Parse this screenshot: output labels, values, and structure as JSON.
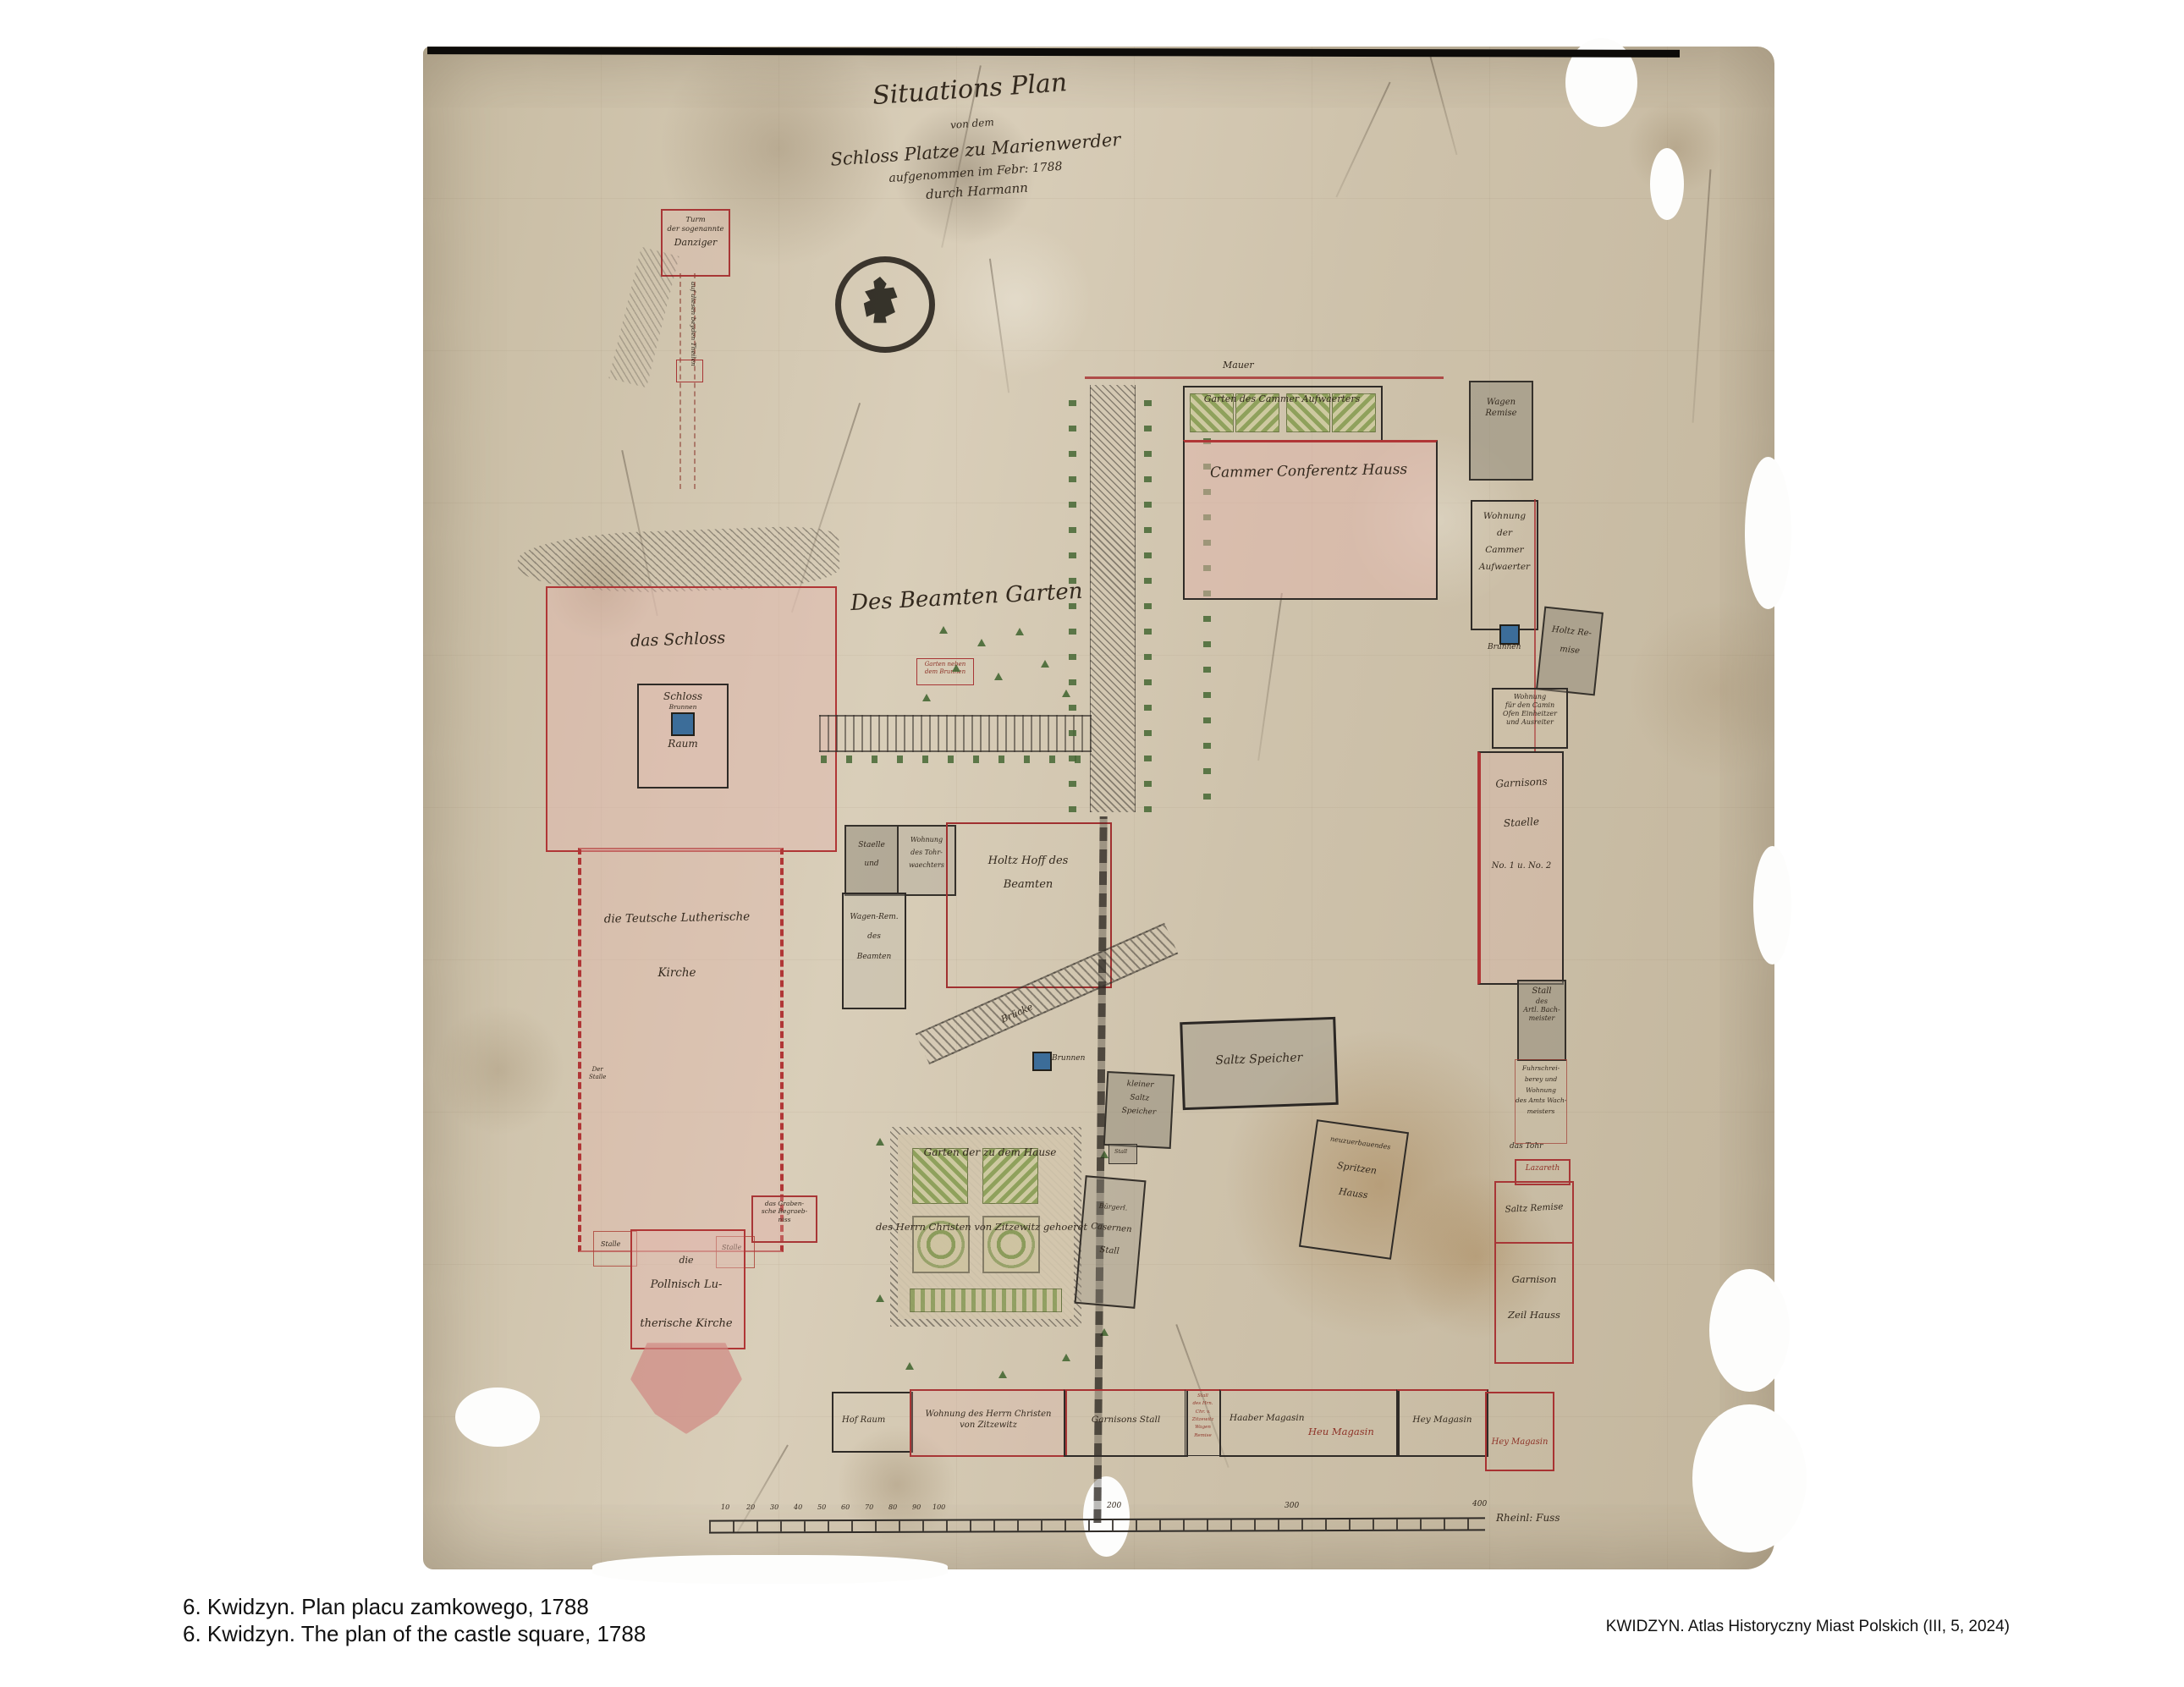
{
  "palette": {
    "red_ink": "#a83636",
    "black_ink": "#2f2b27",
    "pink_wash": "#e2b5ac",
    "garden_green": "#8ca05c",
    "water_blue": "#3c6d99",
    "parchment": "#cfc2aa"
  },
  "captions": {
    "polish": "6. Kwidzyn. Plan placu zamkowego, 1788",
    "english": "6. Kwidzyn. The plan of the castle square, 1788",
    "source": "KWIDZYN. Atlas Historyczny Miast Polskich (III, 5, 2024)"
  },
  "map": {
    "title": {
      "l1": "Situations Plan",
      "l2": "von dem",
      "l3": "Schloss Platze zu Marienwerder",
      "l4": "aufgenommen im Febr: 1788",
      "l5": "durch Harmann"
    },
    "labels": {
      "danziger": {
        "l1": "Turm",
        "l2": "der sogenannte",
        "l3": "Danziger"
      },
      "corridor_note": "auf diesen beyden Theilen",
      "mauer": "Mauer",
      "garten_aufwaerter": "Garten des Cammer Aufwaerters",
      "conferenz_haus": "Cammer Conferentz Hauss",
      "wagen_remise": {
        "l1": "Wagen",
        "l2": "Remise"
      },
      "wohnung_aufwaerter": {
        "l1": "Wohnung",
        "l2": "der",
        "l3": "Cammer",
        "l4": "Aufwaerter"
      },
      "brunnen_right": "Brunnen",
      "holtz_remise": {
        "l1": "Holtz Re-",
        "l2": "mise"
      },
      "camin": {
        "l1": "Wohnung",
        "l2": "für den Camin",
        "l3": "Ofen Einheitzer",
        "l4": "und Ausreiter"
      },
      "garnisons_staelle": {
        "l1": "Garnisons",
        "l2": "Staelle",
        "l3": "No. 1 u. No. 2"
      },
      "stall_artl": {
        "l1": "Stall",
        "l2": "des",
        "l3": "Artl. Bach-",
        "l4": "meister"
      },
      "fuhrschreiberey": {
        "l1": "Fuhrschrei-",
        "l2": "berey und",
        "l3": "Wohnung",
        "l4": "des Amts Wach-",
        "l5": "meisters"
      },
      "tohr": "das Tohr",
      "lazareth": "Lazareth",
      "saltz_remise": "Saltz Remise",
      "garnison_zeil": {
        "l1": "Garnison",
        "l2": "Zeil Hauss"
      },
      "beamten_garten": "Des Beamten Garten",
      "garten_brunnen": {
        "l1": "Garten neben",
        "l2": "dem Brunnen"
      },
      "das_schloss": "das Schloss",
      "schloss_brunnen": {
        "l1": "Schloss",
        "l2": "Brunnen",
        "l3": "Raum"
      },
      "teutsche_kirche": {
        "l1": "die Teutsche Lutherische",
        "l2": "Kirche"
      },
      "der_stalle": {
        "l1": "Der",
        "l2": "Stalle"
      },
      "grabensche": {
        "l1": "das Graben-",
        "l2": "sche Begraeb-",
        "l3": "niss"
      },
      "stalle_a": "Stalle",
      "stalle_b": "Stalle",
      "pollnisch_kirche": {
        "l1": "die",
        "l2": "Pollnisch Lu-",
        "l3": "therische Kirche"
      },
      "staelle_und": {
        "l1": "Staelle",
        "l2": "und"
      },
      "tohrwaechter": {
        "l1": "Wohnung",
        "l2": "des Tohr-",
        "l3": "waechters"
      },
      "wagen_beamten": {
        "l1": "Wagen-Rem.",
        "l2": "des",
        "l3": "Beamten"
      },
      "holtz_hoff": {
        "l1": "Holtz Hoff des",
        "l2": "Beamten"
      },
      "bruecke": "Brücke",
      "brunnen_mid": "Brunnen",
      "kleiner_saltz": {
        "l1": "kleiner",
        "l2": "Saltz",
        "l3": "Speicher"
      },
      "stall_tiny": "Stall",
      "saltz_speicher": "Saltz Speicher",
      "spritzen": {
        "l1": "neuzuerbauendes",
        "l2": "Spritzen",
        "l3": "Hauss"
      },
      "garten_zitzewitz": {
        "l1": "Garten der zu dem Hause",
        "l2": "des Herrn Christen von Zitzewitz gehoeret"
      },
      "casernen": {
        "l1": "Bürgerl.",
        "l2": "Casernen",
        "l3": "Stall"
      }
    },
    "bottom_strip": {
      "hof_raum": "Hof Raum",
      "zitzewitz": {
        "l1": "Wohnung des Herrn Christen",
        "l2": "von Zitzewitz"
      },
      "garnisons_stall": "Garnisons Stall",
      "red_cell": [
        "Stall",
        "des Hrn.",
        "Chr. v.",
        "Zitzewitz",
        "Wagen",
        "Remise"
      ],
      "haaber": "Haaber Magasin",
      "heu_red": "Heu Magasin",
      "hey_black": "Hey Magasin",
      "hey_red": "Hey Magasin"
    },
    "scale": {
      "numbers": [
        "10",
        "20",
        "30",
        "40",
        "50",
        "60",
        "70",
        "80",
        "90",
        "100",
        "200",
        "300",
        "400"
      ],
      "unit": "Rheinl: Fuss"
    }
  }
}
